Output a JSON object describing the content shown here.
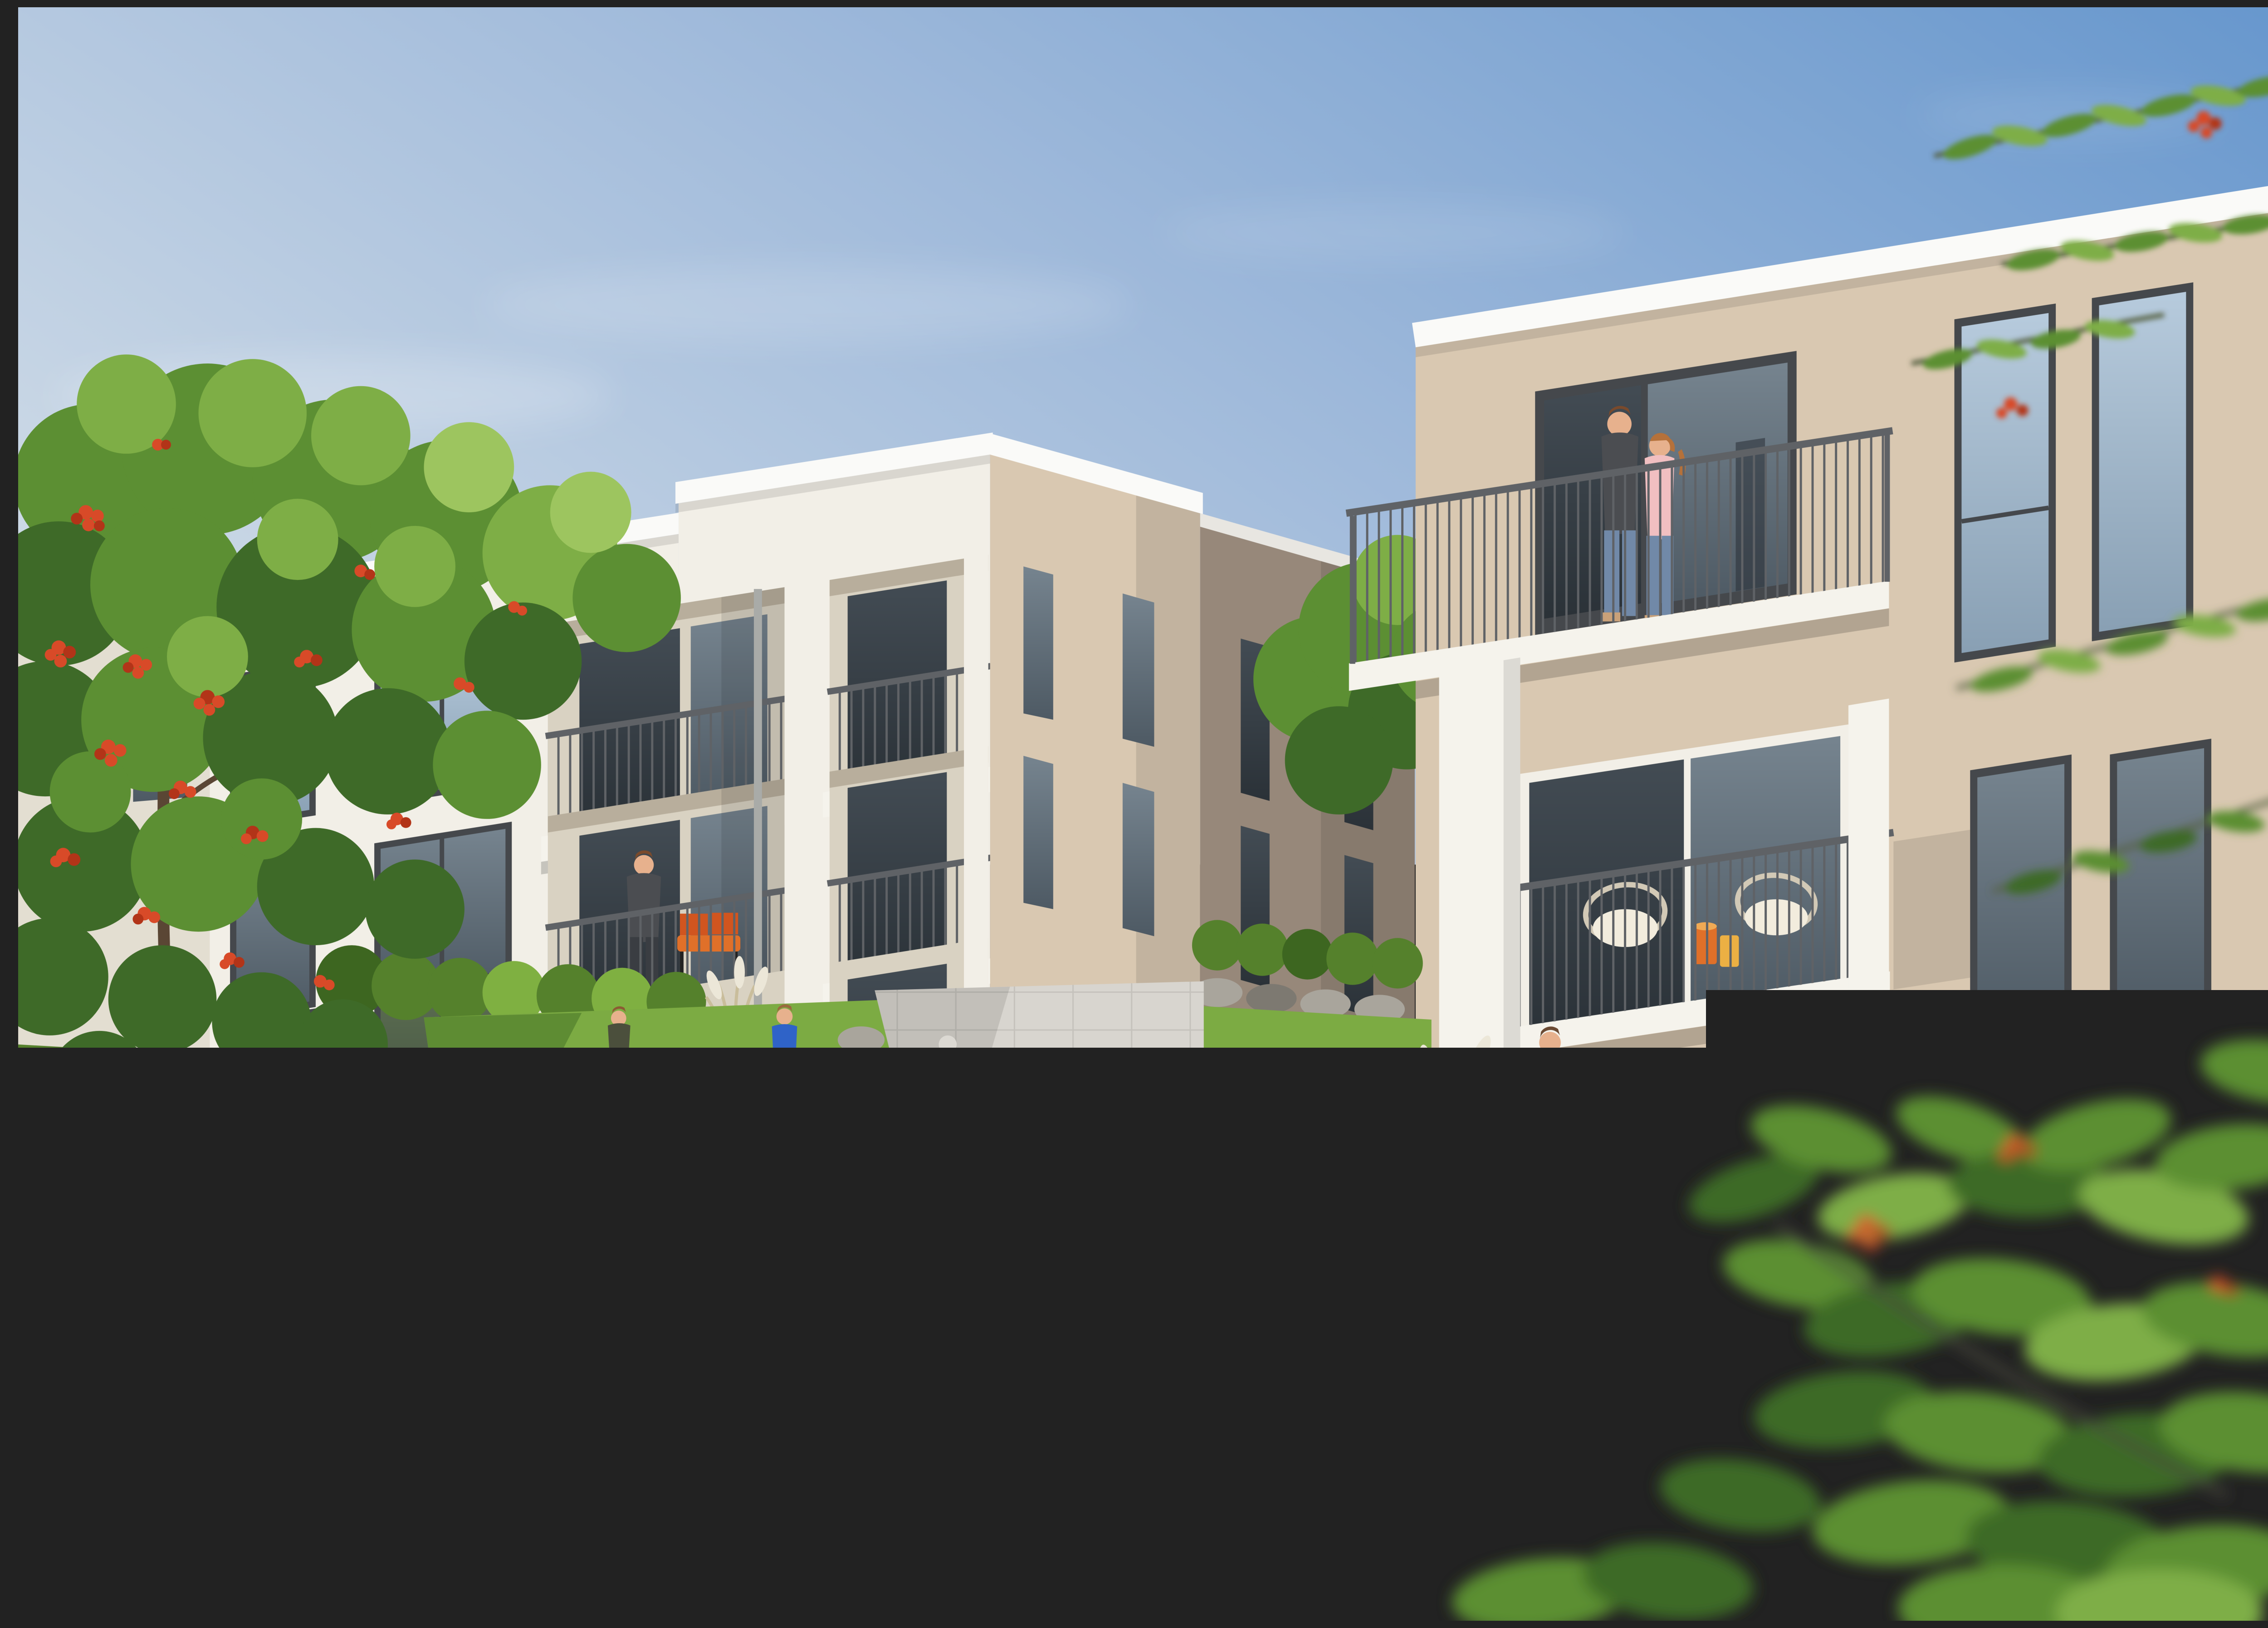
{
  "scene": {
    "label": "Sunny photorealistic rendering of a modern residential courtyard with two apartment buildings",
    "description": "Two modern flat-roofed three-storey apartment buildings with grey vertical-bar balcony railings face a landscaped courtyard garden with clipped hedges, lawns, gravel paths with concrete edging, a rowan tree full of red berries on the left and blurred sumac branches framing the right. Residents stand on balconies, children play ball on the lawn, an elderly woman sits on a terrace and a couple enjoys wine at a wooden garden table.",
    "sun": "bright daylight from the upper left",
    "people_count": 9
  },
  "colors": {
    "sky-top": "#6797cd",
    "sky-mid": "#a5bedb",
    "sky-low": "#d5dfe9",
    "sky-horizon": "#eaeff4",
    "facade-white": "#f2efe7",
    "facade-white-shade": "#e3ded1",
    "facade-cream": "#d9d2c2",
    "facade-beige": "#d9c8b1",
    "facade-beige-dark": "#c8b69e",
    "facade-taupe": "#97887a",
    "roof-white": "#fafaf8",
    "window-frame": "#45484c",
    "rail": "#5f6266",
    "rail-light": "#94979b",
    "slab-white": "#f5f3ec",
    "hedge-light": "#aed45f",
    "hedge-mid": "#7fb041",
    "hedge-dark": "#55812c",
    "hedge-deep": "#3d6620",
    "lawn": "#7cab43",
    "lawn-shade": "#5e8c33",
    "meadow": "#668f3a",
    "meadow-dark": "#4c7230",
    "gravel": "#cfc3ad",
    "curb": "#b7b2a9",
    "curb-dark": "#8d877b",
    "rock": "#a9a59c",
    "rock-dark": "#7d7971",
    "trunk": "#5a4634",
    "leaf-dark": "#3e6a28",
    "leaf-mid": "#5c8f33",
    "leaf-light": "#7eae46",
    "leaf-pale": "#9dc55f",
    "berry": "#d84a28",
    "berry-dark": "#b23418",
    "tile": "#d8d5cf",
    "wood": "#c99c52",
    "wood-dark": "#a97f39",
    "orange": "#e07029",
    "cushion": "#f2ecdd",
    "wicker": "#d2c9b6",
    "skin": "#e7b18d",
    "denim": "#7189a8",
    "shirt-dark": "#4b4d51",
    "pink": "#f1bfc1",
    "blazer": "#8d8d93",
    "white-hair": "#dcd9d3",
    "plume": "#ece7d8"
  },
  "objects": {
    "sky": {
      "label": "clear blue sky with thin clouds"
    },
    "left_building": {
      "label": "white three-storey apartment building with recessed balconies and beige side wall",
      "floors": 3
    },
    "middle_building": {
      "label": "taupe background building with narrow windows"
    },
    "right_building": {
      "label": "beige three-storey apartment building with stacked white-framed balconies",
      "floors": 3
    },
    "railings": {
      "label": "grey vertical-bar balcony railings"
    },
    "garden": {
      "label": "courtyard garden with clipped hedges, lawns and flowering meadow"
    },
    "paths": {
      "label": "light gravel paths with concrete edging"
    },
    "rowan_tree": {
      "label": "rowan tree with clusters of red berries"
    },
    "foreground_branches": {
      "label": "blurred sumac branches with red berries framing the view"
    },
    "people": {
      "couple_top_balcony": "couple standing on the top balcony",
      "man_mid_balcony": "man with crossed arms on a middle balcony",
      "elderly_woman_terrace": "elderly woman seated on a ground-floor terrace",
      "boys_on_lawn": "two boys playing ball on the lawn",
      "man_standing_terrace": "man in a grey blazer standing on the terrace",
      "woman_at_table": "woman seated at a wooden garden table"
    },
    "furniture": {
      "wooden_table": "wooden dining table with wine bottle and candle",
      "white_chairs": "white padded garden chairs",
      "wicker_chairs": "wicker chairs with cream cushions and orange side tables",
      "orange_bench": "orange balcony bench",
      "butterfly_chair": "black butterfly chair with stool"
    }
  }
}
